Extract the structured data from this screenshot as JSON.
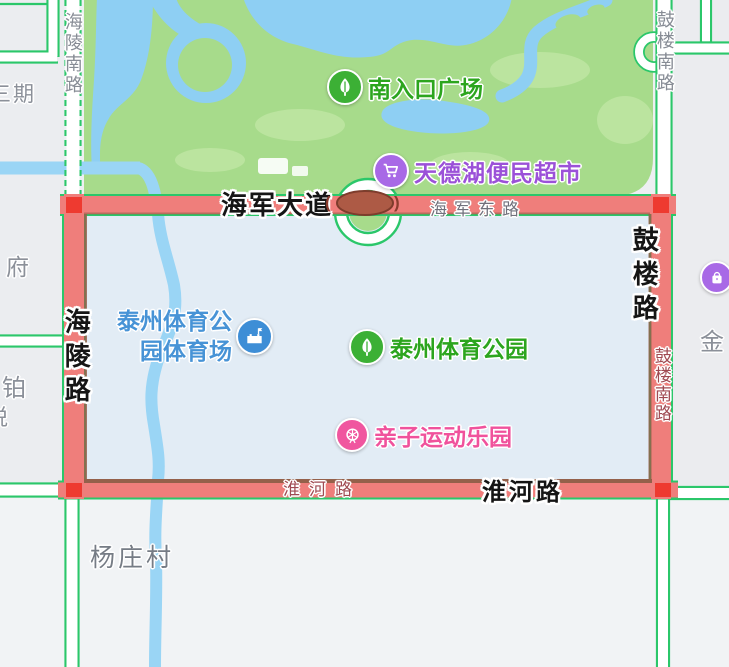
{
  "map": {
    "poi_labels": {
      "south_entrance_plaza": "南入口广场",
      "tiandehu_market": "天德湖便民超市",
      "stadium_line1": "泰州体育公",
      "stadium_line2": "园体育场",
      "sports_park": "泰州体育公园",
      "kids_park": "亲子运动乐园"
    },
    "road_labels": {
      "hailing_south_road": "海陵南路",
      "gulou_south_road_top": "鼓楼南路",
      "gulou_south_road_on_red": "鼓楼南路",
      "gulou_road": "鼓楼路",
      "hailing_road": "海陵路",
      "haijun_avenue": "海军大道",
      "haijun_east_road": "海军东路",
      "huaihe_road_small": "淮河路",
      "huaihe_road_bold": "淮河路"
    },
    "area_labels": {
      "yangzhuang_village": "杨庄村",
      "phase_three": "三期",
      "fu": "府",
      "bo": "铂",
      "yue": "悦",
      "jin": "金"
    },
    "bridge_marks": {
      "left": "(",
      "right": ")"
    },
    "colors": {
      "park_green": "#a7db8b",
      "water_blue": "#8ecff3",
      "highlight_fill": "#e2ecf5",
      "highlight_border": "#94604a",
      "selected_road_red": "#ef7e7b",
      "corner_marker_red": "#ee3a30",
      "road_casing_green": "#2bc76a",
      "bridge_oval_brown": "#ad5a45",
      "poi_green": "#3cb035",
      "poi_purple": "#a869e6",
      "poi_blue": "#3e8ed6",
      "poi_pink": "#f0569f",
      "text_green": "#2ca51e",
      "text_purple": "#9b51d8",
      "text_blue": "#4793d6",
      "text_pink": "#f0529c",
      "text_dark_red": "#a04a52",
      "text_gray": "#878c95",
      "text_black": "#151515"
    }
  }
}
